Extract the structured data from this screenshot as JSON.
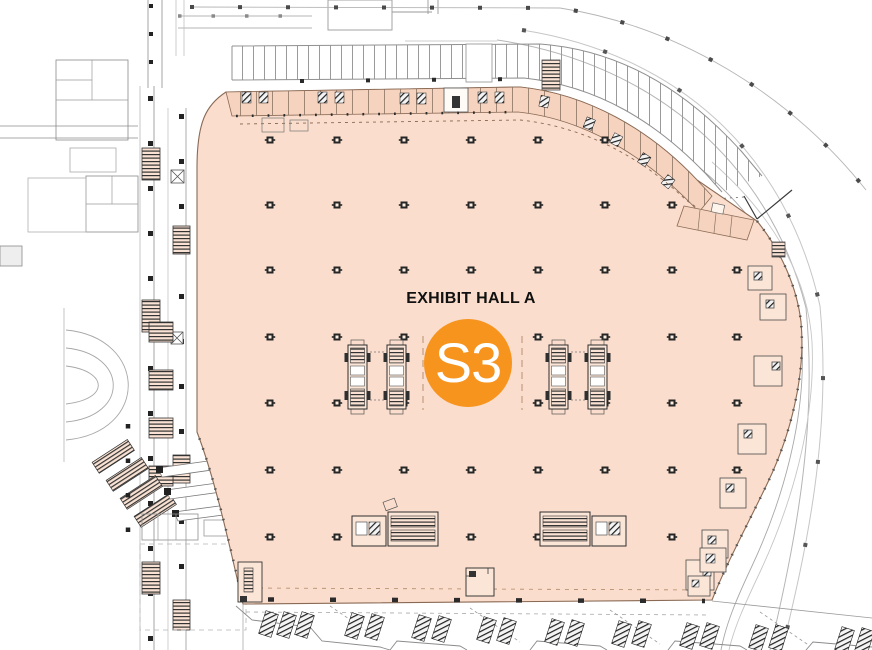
{
  "floorplan": {
    "hall": {
      "label": "EXHIBIT HALL A"
    },
    "badge": {
      "label": "S3"
    },
    "colors": {
      "hall_fill": "#FADDCC",
      "badge_fill": "#F7941E",
      "badge_text": "#FFFFFF",
      "label_color": "#111111"
    }
  }
}
